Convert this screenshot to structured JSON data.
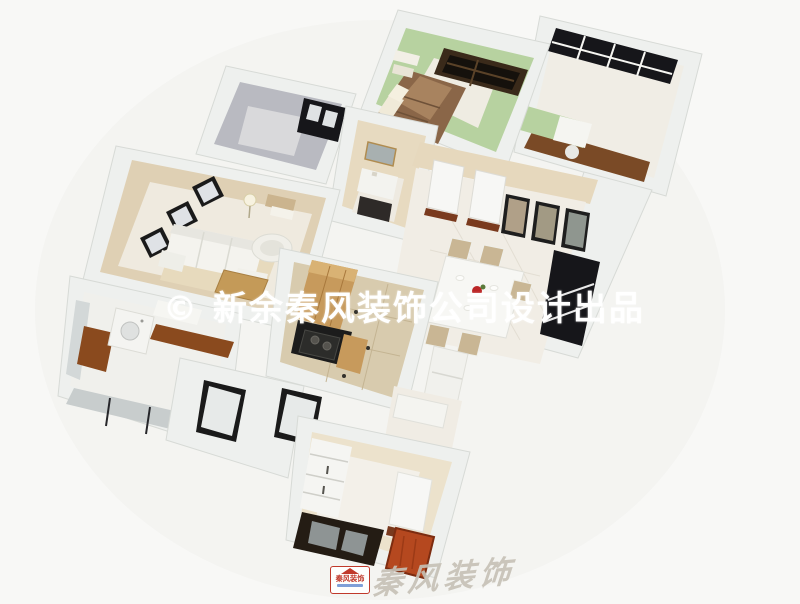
{
  "watermark": {
    "text": "© 新余秦风装饰公司设计出品"
  },
  "footer_logo": {
    "badge_text": "秦风装饰",
    "calligraphy_text": "秦风装饰"
  },
  "palette": {
    "background": "#f8f8f6",
    "wall": "#eef0ee",
    "wall_shade": "#d7dad6",
    "green_wall": "#b7d2a0",
    "tan_wall": "#dfd0b4",
    "beige_wall": "#e6d8bd",
    "gray_wall": "#b9bac1",
    "floor": "#efeadf",
    "floor_tile": "#d8cbae",
    "wood": "#c79a5c",
    "wood_dark": "#7a4a26",
    "window_dark": "#16161a",
    "red_accent": "#b5481f",
    "logo_red": "#c0392b",
    "watermark": "#ffffff"
  }
}
